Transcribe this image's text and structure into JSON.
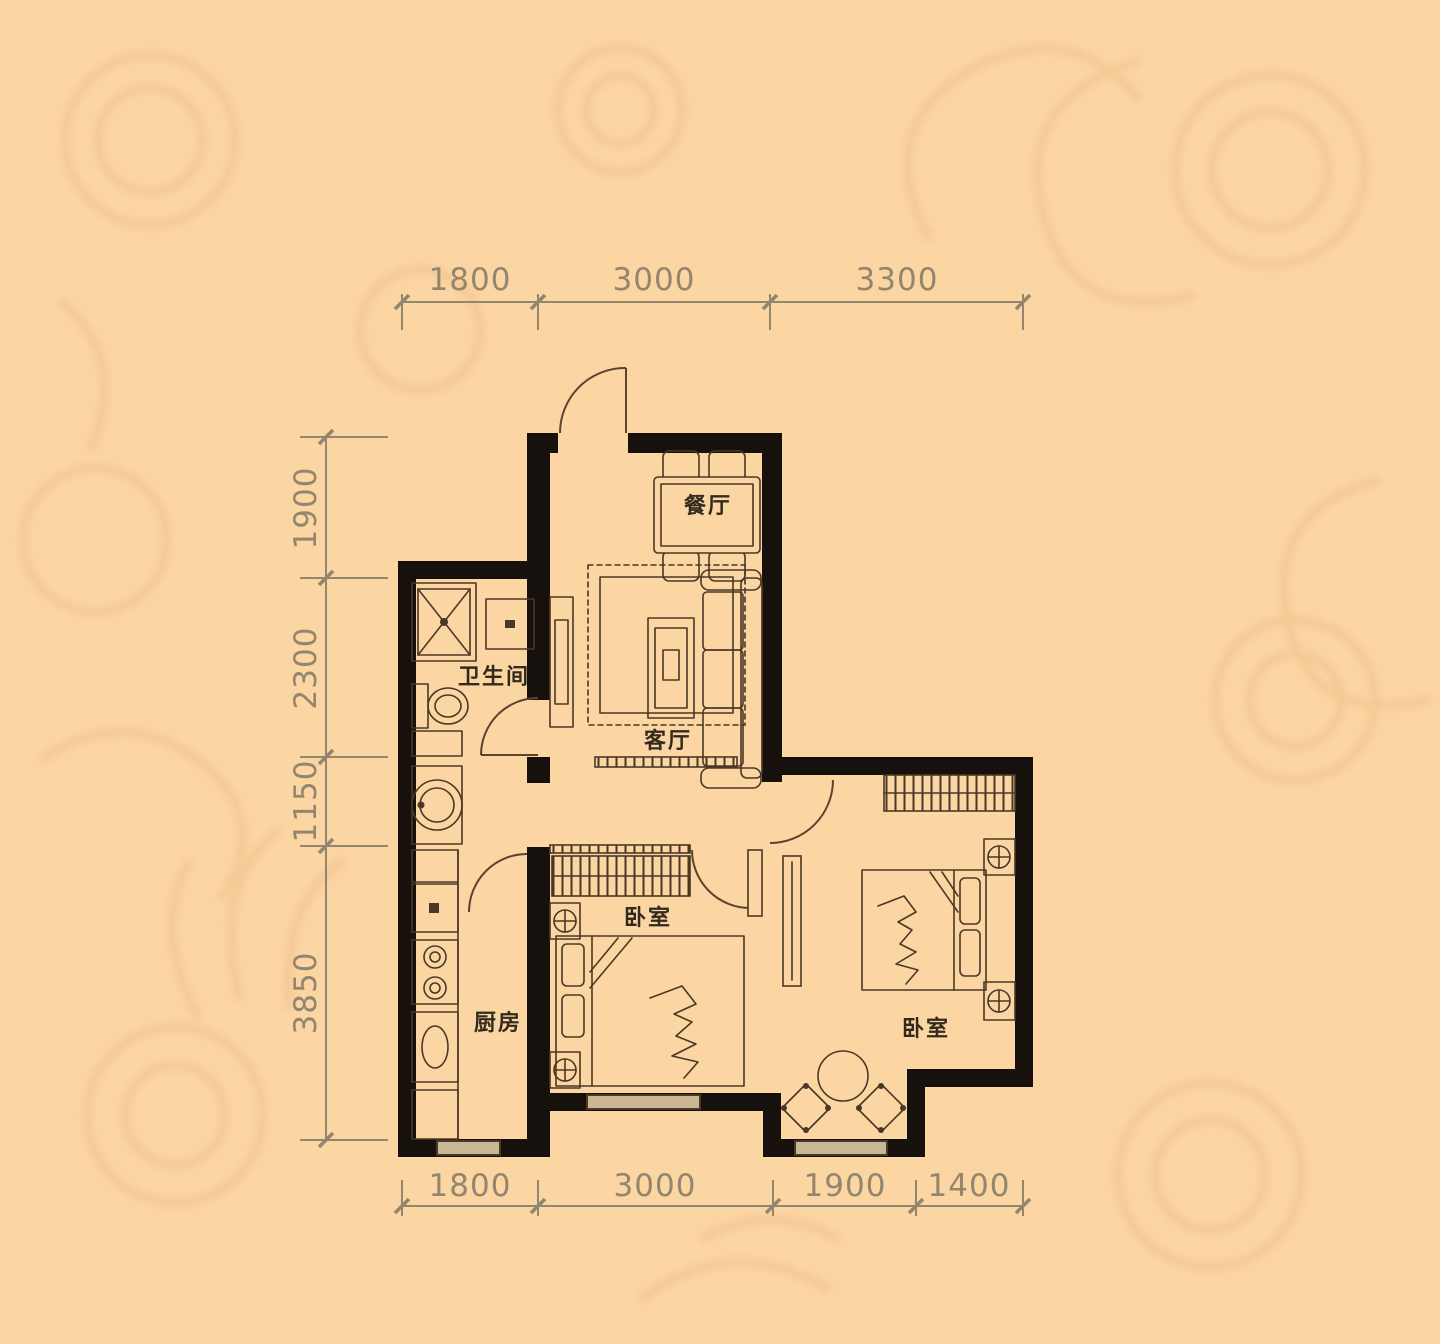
{
  "title": "two-bedroom apartment floor plan",
  "colors": {
    "bg": "#fbd5a2",
    "pattern": "#f1bf8d",
    "wall": "#16110c",
    "line": "#4a3826",
    "door": "#5a4430",
    "dim": "#93866f",
    "label": "#332a1e",
    "window": "#cab795"
  },
  "rooms": [
    {
      "id": "dining",
      "label": "餐厅"
    },
    {
      "id": "living",
      "label": "客厅"
    },
    {
      "id": "bathroom",
      "label": "卫生间"
    },
    {
      "id": "kitchen",
      "label": "厨房"
    },
    {
      "id": "bedroom-middle",
      "label": "卧室"
    },
    {
      "id": "bedroom-right",
      "label": "卧室"
    }
  ],
  "dimensions": {
    "top": [
      "1800",
      "3000",
      "3300"
    ],
    "left": [
      "1900",
      "2300",
      "1150",
      "3850"
    ],
    "bottom": [
      "1800",
      "3000",
      "1900",
      "1400"
    ]
  }
}
